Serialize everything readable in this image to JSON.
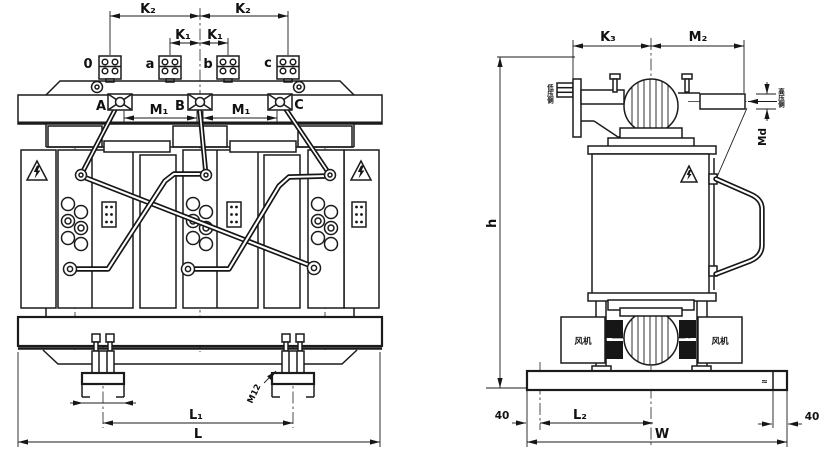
{
  "front_view": {
    "lv_terminals": [
      "0",
      "a",
      "b",
      "c"
    ],
    "hv_terminals": [
      "A",
      "B",
      "C"
    ],
    "dims": {
      "k2_left": "K₂",
      "k2_right": "K₂",
      "k1_left": "K₁",
      "k1_right": "K₁",
      "m1_left": "M₁",
      "m1_right": "M₁",
      "l1": "L₁",
      "l_total": "L",
      "foot_bolt": "M12"
    }
  },
  "side_view": {
    "dims": {
      "k3": "K₃",
      "m2": "M₂",
      "md": "Md",
      "h": "h",
      "l2": "L₂",
      "w_total": "W",
      "edge_left": "40",
      "edge_right": "40"
    },
    "fan_left": "风机",
    "fan_right": "风机",
    "lv_outlet": "低压侧",
    "hv_outlet": "高压侧",
    "base_mark": "≈"
  }
}
